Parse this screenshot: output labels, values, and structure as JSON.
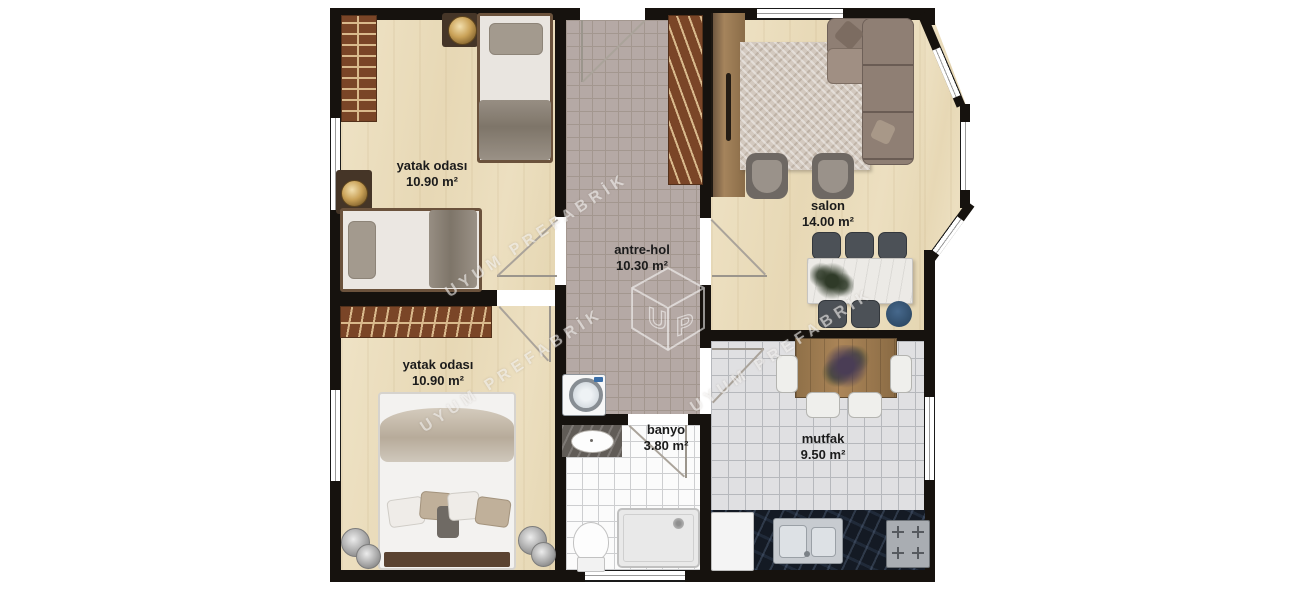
{
  "watermark": {
    "brand": "UYUM PREFABRİK",
    "logo_u": "U",
    "logo_p": "P"
  },
  "rooms": {
    "bedroom_top": {
      "name": "yatak odası",
      "area": "10.90 m²"
    },
    "hall": {
      "name": "antre-hol",
      "area": "10.30 m²"
    },
    "salon": {
      "name": "salon",
      "area": "14.00 m²"
    },
    "bedroom_bottom": {
      "name": "yatak odası",
      "area": "10.90 m²"
    },
    "bathroom": {
      "name": "banyo",
      "area": "3.80 m²"
    },
    "kitchen": {
      "name": "mutfak",
      "area": "9.50 m²"
    }
  },
  "colors": {
    "wall": "#16120e",
    "wood_floor": "#ebdfc0",
    "hall_tile": "#b5a9a5",
    "kitchen_tile": "#e0e0e2",
    "bath_tile": "#fbfbfb",
    "rug_brick": "#7a4527",
    "counter_dark": "#141a24",
    "stool_blue": "#3a5a7a"
  }
}
